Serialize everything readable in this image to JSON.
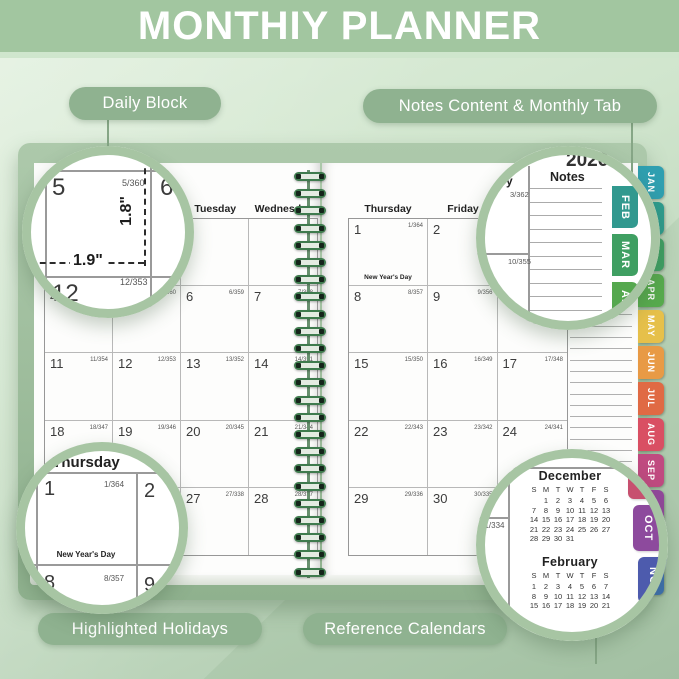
{
  "title": "MONTHIY PLANNER",
  "callouts": {
    "daily_block": "Daily Block",
    "notes_tab": "Notes Content & Monthly Tab",
    "holidays": "Highlighted Holidays",
    "reference": "Reference Calendars"
  },
  "left_page": {
    "headers": [
      "",
      "",
      "Tuesday",
      "Wednesday"
    ],
    "weeks": [
      [
        {
          "d": "",
          "doy": ""
        },
        {
          "d": "",
          "doy": ""
        },
        {
          "d": "",
          "doy": ""
        },
        {
          "d": "",
          "doy": ""
        }
      ],
      [
        {
          "d": "4",
          "doy": "4/361"
        },
        {
          "d": "5",
          "doy": "5/360"
        },
        {
          "d": "6",
          "doy": "6/359"
        },
        {
          "d": "7",
          "doy": "7/358"
        }
      ],
      [
        {
          "d": "11",
          "doy": "11/354"
        },
        {
          "d": "12",
          "doy": "12/353"
        },
        {
          "d": "13",
          "doy": "13/352"
        },
        {
          "d": "14",
          "doy": "14/351"
        }
      ],
      [
        {
          "d": "18",
          "doy": "18/347"
        },
        {
          "d": "19",
          "doy": "19/346"
        },
        {
          "d": "20",
          "doy": "20/345"
        },
        {
          "d": "21",
          "doy": "21/344"
        }
      ],
      [
        {
          "d": "25",
          "doy": "25/340"
        },
        {
          "d": "26",
          "doy": "26/339"
        },
        {
          "d": "27",
          "doy": "27/338"
        },
        {
          "d": "28",
          "doy": "28/337"
        }
      ]
    ]
  },
  "right_page": {
    "headers": [
      "Thursday",
      "Friday",
      "Saturday"
    ],
    "notes_header": "Notes",
    "weeks": [
      [
        {
          "d": "1",
          "doy": "1/364",
          "h": "New Year's Day"
        },
        {
          "d": "2",
          "doy": "2/363"
        },
        {
          "d": "3",
          "doy": "3/362"
        }
      ],
      [
        {
          "d": "8",
          "doy": "8/357"
        },
        {
          "d": "9",
          "doy": "9/356"
        },
        {
          "d": "10",
          "doy": "10/355"
        }
      ],
      [
        {
          "d": "15",
          "doy": "15/350"
        },
        {
          "d": "16",
          "doy": "16/349"
        },
        {
          "d": "17",
          "doy": "17/348"
        }
      ],
      [
        {
          "d": "22",
          "doy": "22/343"
        },
        {
          "d": "23",
          "doy": "23/342"
        },
        {
          "d": "24",
          "doy": "24/341"
        }
      ],
      [
        {
          "d": "29",
          "doy": "29/336"
        },
        {
          "d": "30",
          "doy": "30/335"
        },
        {
          "d": "31",
          "doy": "31/334"
        }
      ]
    ]
  },
  "tabs": [
    {
      "label": "JAN",
      "color": "#2f9fb0"
    },
    {
      "label": "FEB",
      "color": "#2d9c8e"
    },
    {
      "label": "MAR",
      "color": "#3ea063"
    },
    {
      "label": "APR",
      "color": "#57ab4d"
    },
    {
      "label": "MAY",
      "color": "#e6c04a"
    },
    {
      "label": "JUN",
      "color": "#e89a45"
    },
    {
      "label": "JUL",
      "color": "#e06a44"
    },
    {
      "label": "AUG",
      "color": "#d94f63"
    },
    {
      "label": "SEP",
      "color": "#c04a80"
    },
    {
      "label": "OCT",
      "color": "#93479c"
    },
    {
      "label": "NOV",
      "color": "#5d55a9"
    },
    {
      "label": "DEC",
      "color": "#3c6fb4"
    }
  ],
  "magnifiers": {
    "daily": {
      "cell4_doy_tail": "61",
      "cell5": "5",
      "cell5_doy": "5/360",
      "cell6": "6",
      "cell12": "12",
      "cell12_doy": "12/353",
      "width_label": "1.9\"",
      "height_label": "1.8\""
    },
    "notes": {
      "year": "2026",
      "saturday_tail": "y",
      "notes_label": "Notes",
      "doy_3": "3/362",
      "doy_10": "10/355",
      "tabs": [
        {
          "label": "FEB",
          "color": "#31998f"
        },
        {
          "label": "MAR",
          "color": "#3f9f62"
        },
        {
          "label": "APR",
          "color": "#55a84e"
        },
        {
          "label": "MAY",
          "color": "#e3bd4a"
        }
      ]
    },
    "holiday": {
      "weekday": "Thursday",
      "day1": "1",
      "day1_doy": "1/364",
      "day2": "2",
      "holiday_label": "New Year's Day",
      "day8": "8",
      "day8_doy": "8/357",
      "day9": "9"
    },
    "reference": {
      "doy_31": "31/334",
      "december": {
        "title": "December",
        "dow": [
          "S",
          "M",
          "T",
          "W",
          "T",
          "F",
          "S"
        ],
        "rows": [
          [
            "",
            "1",
            "2",
            "3",
            "4",
            "5",
            "6"
          ],
          [
            "7",
            "8",
            "9",
            "10",
            "11",
            "12",
            "13"
          ],
          [
            "14",
            "15",
            "16",
            "17",
            "18",
            "19",
            "20"
          ],
          [
            "21",
            "22",
            "23",
            "24",
            "25",
            "26",
            "27"
          ],
          [
            "28",
            "29",
            "30",
            "31",
            "",
            "",
            ""
          ]
        ]
      },
      "february": {
        "title": "February",
        "dow": [
          "S",
          "M",
          "T",
          "W",
          "T",
          "F",
          "S"
        ],
        "rows": [
          [
            "1",
            "2",
            "3",
            "4",
            "5",
            "6",
            "7"
          ],
          [
            "8",
            "9",
            "10",
            "11",
            "12",
            "13",
            "14"
          ],
          [
            "15",
            "16",
            "17",
            "18",
            "19",
            "20",
            "21"
          ]
        ]
      },
      "tab_slivers": [
        {
          "label": "SEP",
          "color": "#c7506f"
        },
        {
          "label": "OCT",
          "color": "#8d4a9d"
        },
        {
          "label": "NOV",
          "color": "#4d5bad"
        }
      ]
    }
  }
}
